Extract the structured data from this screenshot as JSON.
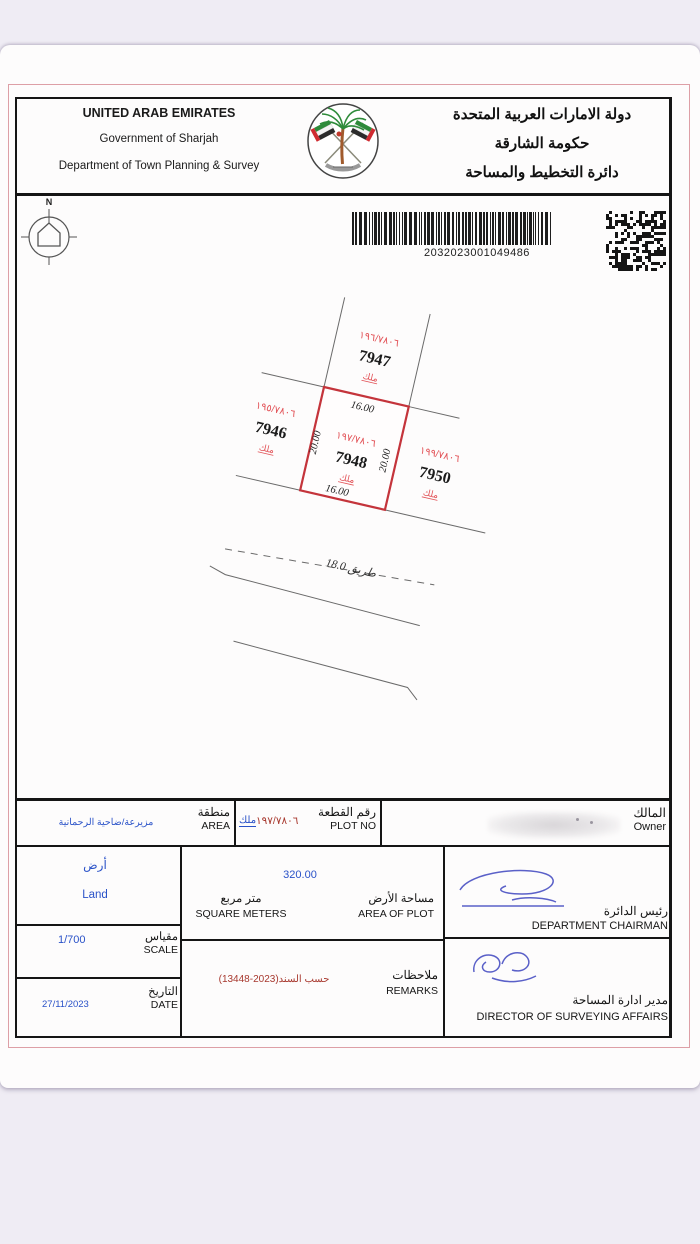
{
  "header": {
    "en": [
      "UNITED ARAB EMIRATES",
      "Government of Sharjah",
      "Department of Town Planning & Survey"
    ],
    "ar": [
      "دولة الامارات العربية المتحدة",
      "حكومة الشارقة",
      "دائرة التخطيط والمساحة"
    ]
  },
  "codes": {
    "barcode_number": "2032023001049486"
  },
  "compass": {
    "north_label": "N"
  },
  "map": {
    "plots": [
      {
        "id": "7947",
        "fraction": "١٩٦/٧٨٠٦",
        "tenure": "ملك"
      },
      {
        "id": "7946",
        "fraction": "١٩٥/٧٨٠٦",
        "tenure": "ملك"
      },
      {
        "id": "7948",
        "fraction": "١٩٧/٧٨٠٦",
        "tenure": "ملك"
      },
      {
        "id": "7950",
        "fraction": "١٩٩/٧٨٠٦",
        "tenure": "ملك"
      }
    ],
    "dimensions": {
      "top": "16.00",
      "bottom": "16.00",
      "left": "20.00",
      "right": "20.00"
    },
    "road_label": "طريق 18.0"
  },
  "table": {
    "area": {
      "label_ar": "منطقة",
      "label_en": "AREA",
      "value": "مزيرعة/ضاحية الرحمانية"
    },
    "plot_no": {
      "label_ar": "رقم القطعة",
      "label_en": "PLOT NO",
      "tenure": "ملك",
      "value": "١٩٧/٧٨٠٦"
    },
    "owner": {
      "label_ar": "المالك",
      "label_en": "Owner"
    },
    "land": {
      "value_ar": "أرض",
      "value_en": "Land"
    },
    "scale": {
      "label_ar": "مقياس",
      "label_en": "SCALE",
      "value": "1/700"
    },
    "date": {
      "label_ar": "التاريخ",
      "label_en": "DATE",
      "value": "27/11/2023"
    },
    "area_of_plot": {
      "label_ar": "مساحة الأرض",
      "label_en": "AREA OF PLOT",
      "unit_ar": "متر مربع",
      "unit_en": "SQUARE METERS",
      "value": "320.00"
    },
    "remarks": {
      "label_ar": "ملاحظات",
      "label_en": "REMARKS",
      "value": "حسب السند(2023-13448)"
    },
    "chairman": {
      "label_ar": "رئيس الدائرة",
      "label_en": "DEPARTMENT CHAIRMAN"
    },
    "director": {
      "label_ar": "مدير ادارة المساحة",
      "label_en": "DIRECTOR OF SURVEYING AFFAIRS"
    }
  },
  "colors": {
    "plot_highlight": "#c4343b",
    "map_label_red": "#e25257",
    "value_blue": "#2a52c8",
    "remark_red": "#a8392f"
  }
}
